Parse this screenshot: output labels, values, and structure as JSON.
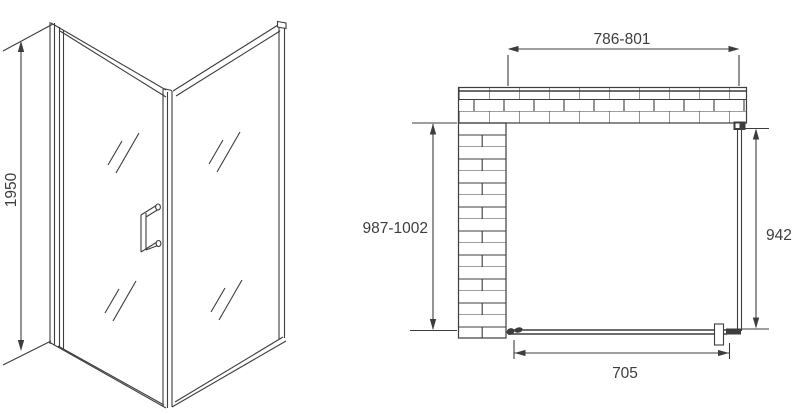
{
  "front_view": {
    "height_label": "1950"
  },
  "plan_view": {
    "width_label": "786-801",
    "depth_label": "987-1002",
    "panel_label": "942",
    "door_label": "705"
  },
  "colors": {
    "line": "#3d3d3d",
    "background": "#ffffff"
  }
}
